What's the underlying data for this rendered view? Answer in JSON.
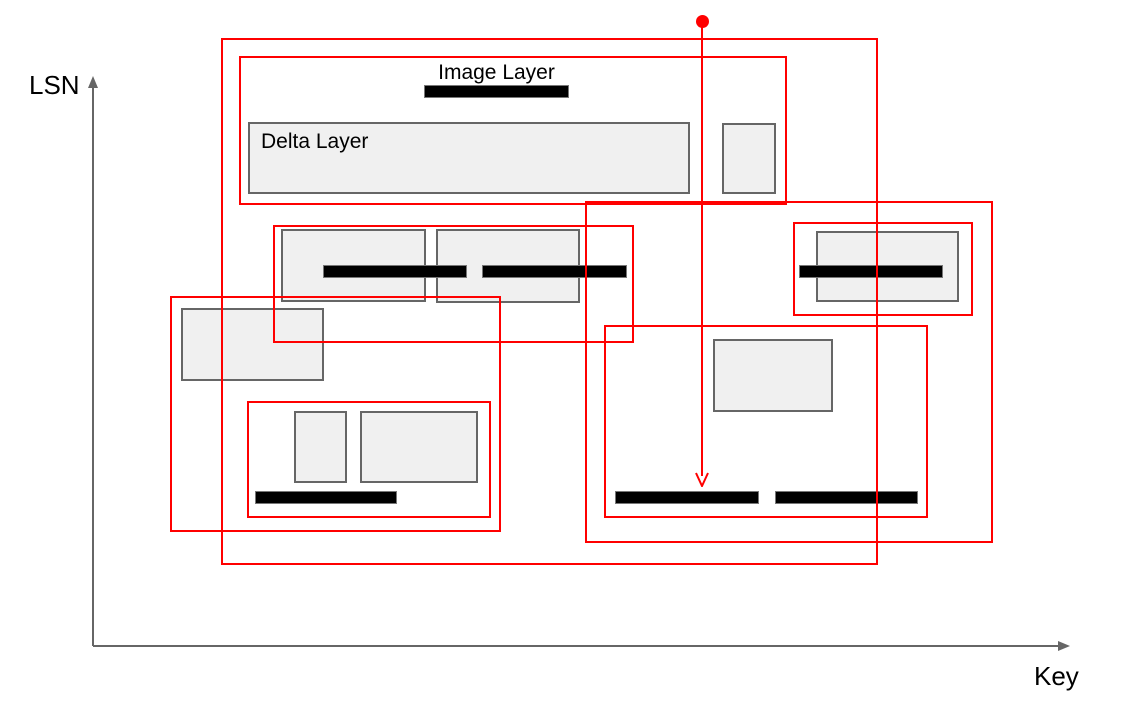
{
  "axes": {
    "y_label": "LSN",
    "x_label": "Key"
  },
  "layers": {
    "image_layer_label": "Image Layer",
    "delta_layer_label": "Delta Layer"
  },
  "colors": {
    "highlight": "#ff0000",
    "box_fill": "#f0f0f0",
    "box_border": "#666666",
    "bar_fill": "#000000",
    "bar_border": "#777777",
    "axis": "#666666",
    "text": "#000000"
  }
}
